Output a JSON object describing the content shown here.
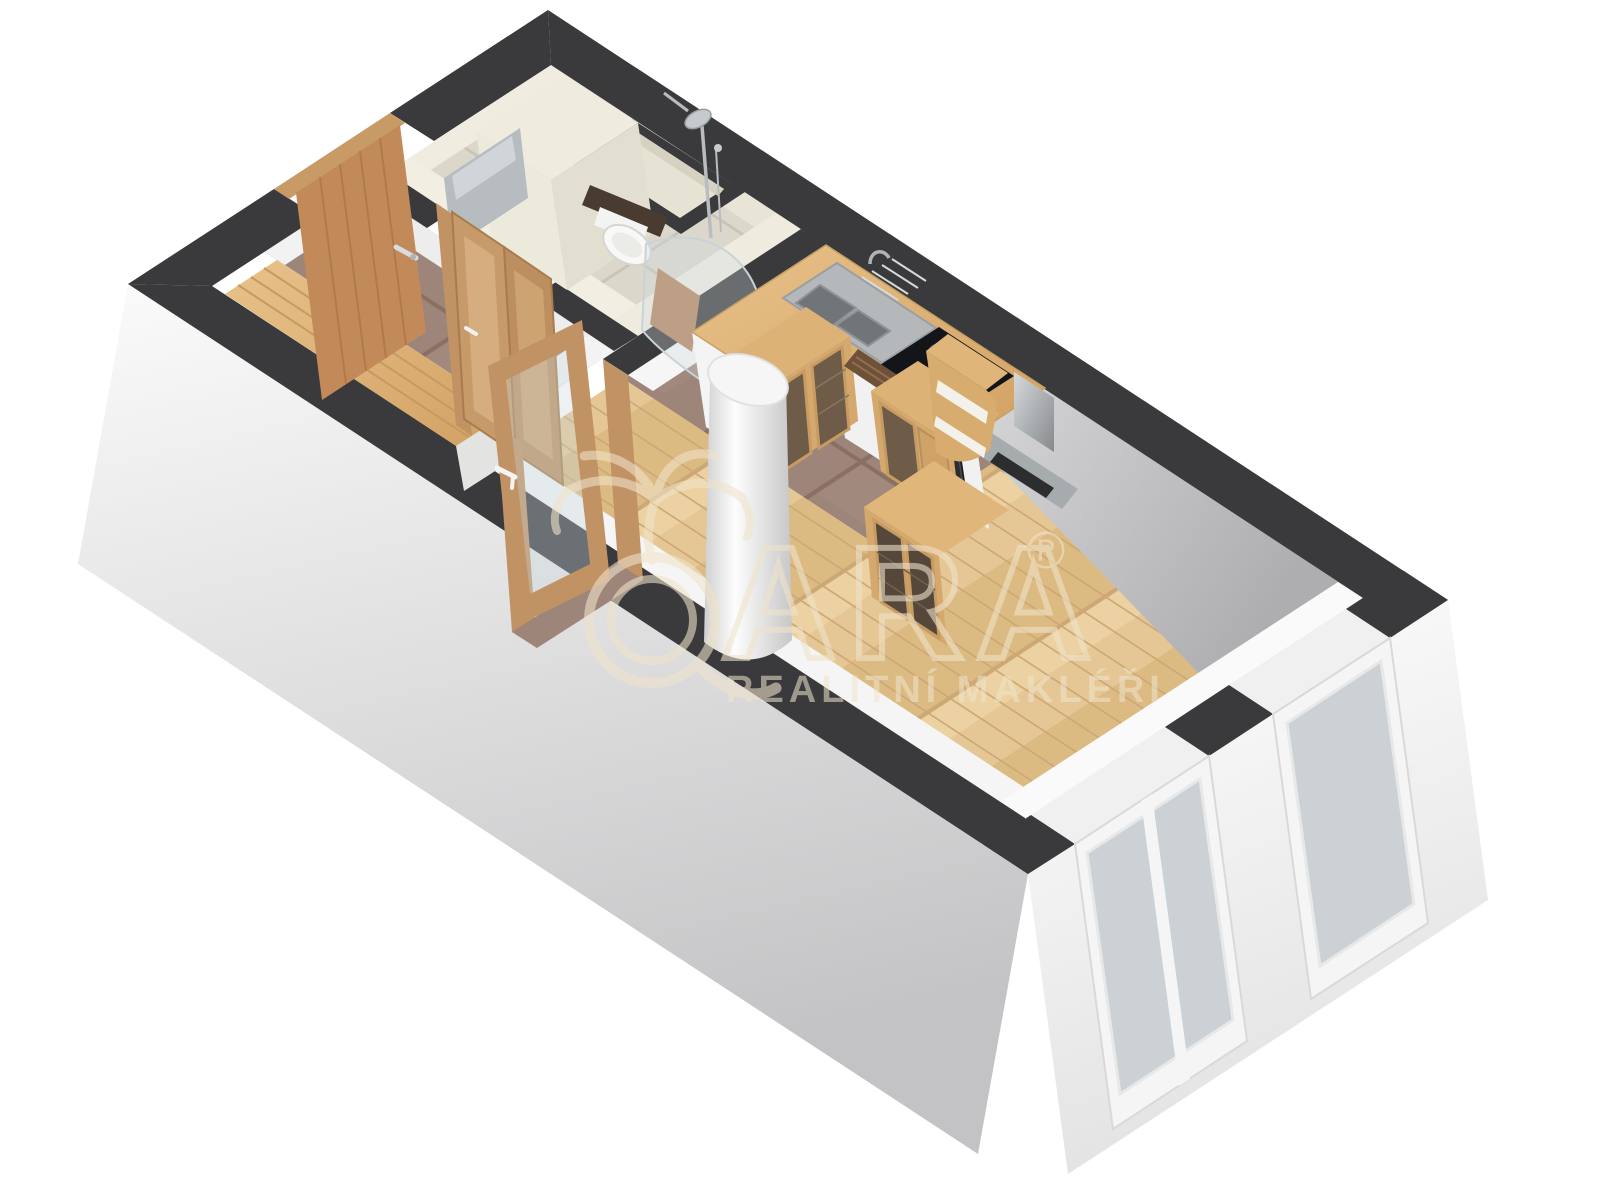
{
  "watermark": {
    "brand": "QARA",
    "brand_letters": "ARA",
    "registered": "®",
    "tagline": "REALITNÍ MAKLÉŘI"
  },
  "palette": {
    "wall_cut": "#3a3a3c",
    "wall_face_light": "#f1f1f1",
    "wall_face_shadow": "#c6c6c8",
    "ne_wall_inner": "#b4b4b6",
    "floor_wood": "#e3c592",
    "floor_tile_brown": "#9d8679",
    "bath_wall_tile": "#edeadc",
    "bath_floor_tile": "#dbd8cb",
    "furniture_wood": "#d9ad74",
    "door_wood": "#c28a59",
    "steel": "#b9bdbf",
    "appliance_black": "#17181b",
    "window_glass": "#cbd1d4",
    "watermark_cream": "#f0e4cb"
  }
}
